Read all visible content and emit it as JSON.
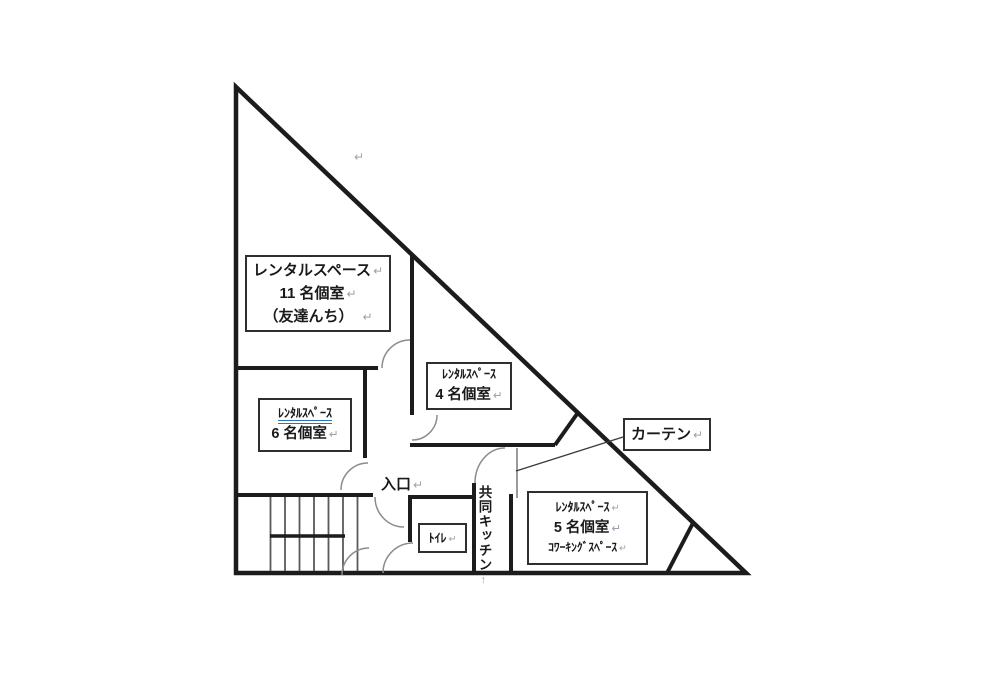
{
  "marks": {
    "return": "↵",
    "vertical_return": "↑",
    "stray_return": "↵"
  },
  "colors": {
    "wall": "#1c1c1c",
    "door_arc": "#8c8c8c",
    "stair_line": "#5a5a5a",
    "curtain_line": "#808080",
    "leader_line": "#3a3a3a",
    "box_border": "#2f2f2f",
    "underline_blue": "#2e74b5",
    "return_mark": "#9aa2ad",
    "text": "#1a1a1a"
  },
  "rooms": {
    "room11": {
      "line1": "レンタルスペース",
      "line2": "11 名個室",
      "line3": "（友達んち）"
    },
    "room6": {
      "line1": "ﾚﾝﾀﾙｽﾍﾟｰｽ",
      "line2": "6 名個室"
    },
    "room4": {
      "line1": "ﾚﾝﾀﾙｽﾍﾟｰｽ",
      "line2": "4 名個室"
    },
    "room5": {
      "line1": "ﾚﾝﾀﾙｽﾍﾟｰｽ",
      "line2": "5 名個室",
      "line3": "ｺﾜｰｷﾝｸﾞｽﾍﾟｰｽ"
    }
  },
  "labels": {
    "curtain": "カーテン",
    "toilet": "ﾄｲﾚ",
    "entrance": "入口",
    "shared_kitchen": "共同キッチン"
  }
}
